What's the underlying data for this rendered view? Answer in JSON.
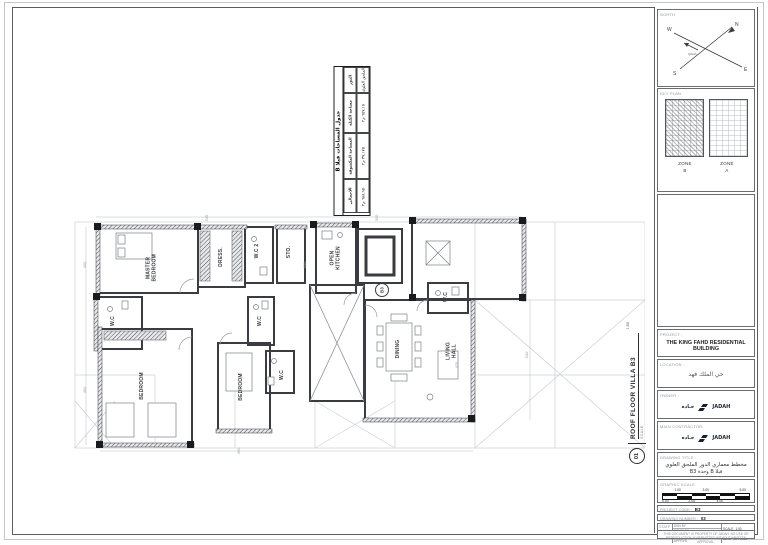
{
  "area_table": {
    "title": "جدول المساحات فيلا B",
    "headers": [
      "الدور",
      "مساحة الكتلة",
      "المساحة المكشوفة",
      "الاجمالي"
    ],
    "row": [
      "الملحق العلوي",
      "٦٥٧,١٨ م٢",
      "٣٧,١٧٥ م٢",
      "٦٨٨,٩٥٠ م٢"
    ]
  },
  "plan": {
    "unit_tag": "B3",
    "rooms": [
      {
        "label": "MASTER BEDROOM"
      },
      {
        "label": "DRESS."
      },
      {
        "label": "W.C 2"
      },
      {
        "label": "STO."
      },
      {
        "label": "OPEN KITCHEN"
      },
      {
        "label": "W.C"
      },
      {
        "label": "W.C"
      },
      {
        "label": "BEDROOM"
      },
      {
        "label": "BEDROOM"
      },
      {
        "label": "W.C"
      },
      {
        "label": "W.C"
      },
      {
        "label": "DINING"
      },
      {
        "label": "LIVING HALL"
      }
    ],
    "dimensions": [
      "400",
      "450",
      "545",
      "500",
      "470",
      "300",
      "360",
      "500"
    ],
    "callout": {
      "number": "01",
      "title": "ROOF FLOOR VILLA B3",
      "scale_label": "SCALE",
      "scale_value": "1:50"
    }
  },
  "titleblock": {
    "north": {
      "label": "NORTH",
      "n": "N",
      "e": "E",
      "s": "S",
      "w": "W",
      "qiblah": "Qiblah"
    },
    "keyplan": {
      "label": "KEY PLAN",
      "zones": [
        {
          "zone": "ZONE",
          "letter": "B"
        },
        {
          "zone": "ZONE",
          "letter": "A"
        }
      ]
    },
    "project": {
      "label": "PROJECT :",
      "value": "THE KING FAHD RESIDENTIAL BUILDING"
    },
    "location": {
      "label": "LOCATION :",
      "value": "حي الملك فهد"
    },
    "owner": {
      "label": "OWNER :",
      "logo_left": "جـادة",
      "logo_right": "JADAH"
    },
    "contractor": {
      "label": "MAIN CONTRACTOR:",
      "logo_left": "جـادة",
      "logo_right": "JADAH"
    },
    "drawing_title": {
      "label": "DRAWING TITLE :",
      "line1": "مخطط معماري الدور الملحق العلوي",
      "line2": "فيلا B وحدة B3"
    },
    "graphic_scale": {
      "label": "GRAPHIC SCALE",
      "top": [
        "1.00",
        "3.00",
        "5.00"
      ],
      "bottom": [
        "0.00",
        "2.00",
        "4.00"
      ]
    },
    "project_code": {
      "label": "PROJECT CODE :",
      "value": "B3"
    },
    "drawing_number": {
      "label": "DRAWING NUMBER :",
      "value": "03"
    },
    "staff": {
      "label": "STAFF",
      "rows": [
        "DSN BY",
        "DRWN BY",
        "CHKD BY",
        "APPRVD"
      ],
      "scale_label": "SCALE",
      "scale_value": "1:50",
      "date_label": "DATE",
      "date_value": "05.7.2022"
    },
    "disclaimer": "THIS DOCUMENT IS PROPERTY OF JADAH. NO USE OR REPRODUCTION IS PERMITTED WITHOUT WRITTEN APPROVAL."
  }
}
